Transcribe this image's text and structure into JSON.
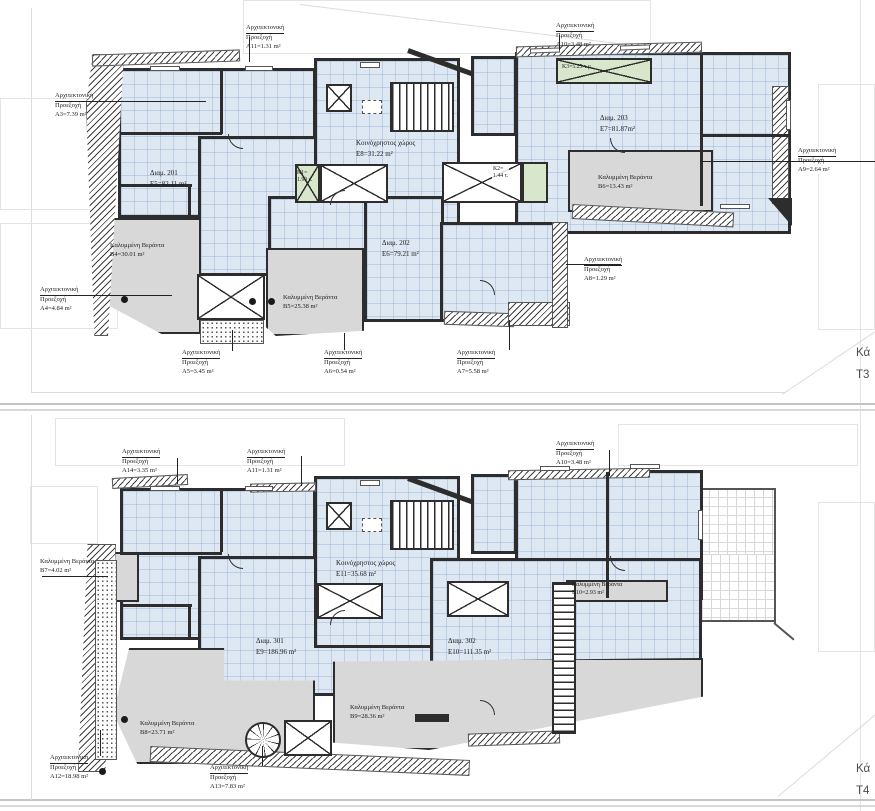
{
  "plans": [
    {
      "corner_label": {
        "line1": "Κά",
        "line2": "T3"
      },
      "units": [
        {
          "name": "Διαμ. 201",
          "area": "E5=82.11 m²"
        },
        {
          "name": "Διαμ. 202",
          "area": "E6=79.21 m²"
        },
        {
          "name": "Διαμ. 203",
          "area": "E7=81.87m²"
        },
        {
          "name": "Κοινόχρηστος χώρος",
          "area": "E8=31.22 m²"
        }
      ],
      "projections": [
        {
          "title": "Αρχιτεκτονική",
          "subtitle": "Προεξοχή",
          "area": "A3=7.39 m²"
        },
        {
          "title": "Αρχιτεκτονική",
          "subtitle": "Προεξοχή",
          "area": "A4=4.84 m²"
        },
        {
          "title": "Αρχιτεκτονική",
          "subtitle": "Προεξοχή",
          "area": "A5=3.45 m²"
        },
        {
          "title": "Αρχιτεκτονική",
          "subtitle": "Προεξοχή",
          "area": "A6=0.54 m²"
        },
        {
          "title": "Αρχιτεκτονική",
          "subtitle": "Προεξοχή",
          "area": "A7=5.58 m²"
        },
        {
          "title": "Αρχιτεκτονική",
          "subtitle": "Προεξοχή",
          "area": "A8=1.29 m²"
        },
        {
          "title": "Αρχιτεκτονική",
          "subtitle": "Προεξοχή",
          "area": "A9=2.64 m²"
        },
        {
          "title": "Αρχιτεκτονική",
          "subtitle": "Προεξοχή",
          "area": "A10=3.48 m²"
        },
        {
          "title": "Αρχιτεκτονική",
          "subtitle": "Προεξοχή",
          "area": "A11=1.31 m²"
        }
      ],
      "verandas": [
        {
          "title": "Καλυμμένη Βεράντα",
          "area": "B4=30.01 m²"
        },
        {
          "title": "Καλυμμένη Βεράντα",
          "area": "B5=25.38 m²"
        },
        {
          "title": "Καλυμμένη Βεράντα",
          "area": "B6=13.43 m²"
        }
      ],
      "skylights": [
        {
          "label": "K1=",
          "area": "1.90 τ."
        },
        {
          "label": "K2=",
          "area": "1.44 τ."
        },
        {
          "label": "K3=5.25 τ.μ",
          "area": ""
        }
      ]
    },
    {
      "corner_label": {
        "line1": "Κά",
        "line2": "T4"
      },
      "units": [
        {
          "name": "Διαμ. 301",
          "area": "E9=186.96 m²"
        },
        {
          "name": "Διαμ. 302",
          "area": "E10=111.35 m²"
        },
        {
          "name": "Κοινόχρηστος χώρος",
          "area": "E11=35.68 m²"
        }
      ],
      "projections": [
        {
          "title": "Αρχιτεκτονική",
          "subtitle": "Προεξοχή",
          "area": "A10=3.48 m²"
        },
        {
          "title": "Αρχιτεκτονική",
          "subtitle": "Προεξοχή",
          "area": "A11=1.31 m²"
        },
        {
          "title": "Αρχιτεκτονική",
          "subtitle": "Προεξοχή",
          "area": "A12=18.98 m²"
        },
        {
          "title": "Αρχιτεκτονική",
          "subtitle": "Προεξοχή",
          "area": "A13=7.83 m²"
        },
        {
          "title": "Αρχιτεκτονική",
          "subtitle": "Προεξοχή",
          "area": "A14=3.35 m²"
        }
      ],
      "verandas": [
        {
          "title": "Καλυμμένη Βεράντα",
          "area": "B7=4.02 m²"
        },
        {
          "title": "Καλυμμένη Βεράντα",
          "area": "B8=23.71 m²"
        },
        {
          "title": "Καλυμμένη Βεράντα",
          "area": "B9=28.36 m²"
        },
        {
          "title": "Καλυμμένη Βεράντα",
          "area": "B10=2.93 m²"
        }
      ]
    }
  ]
}
